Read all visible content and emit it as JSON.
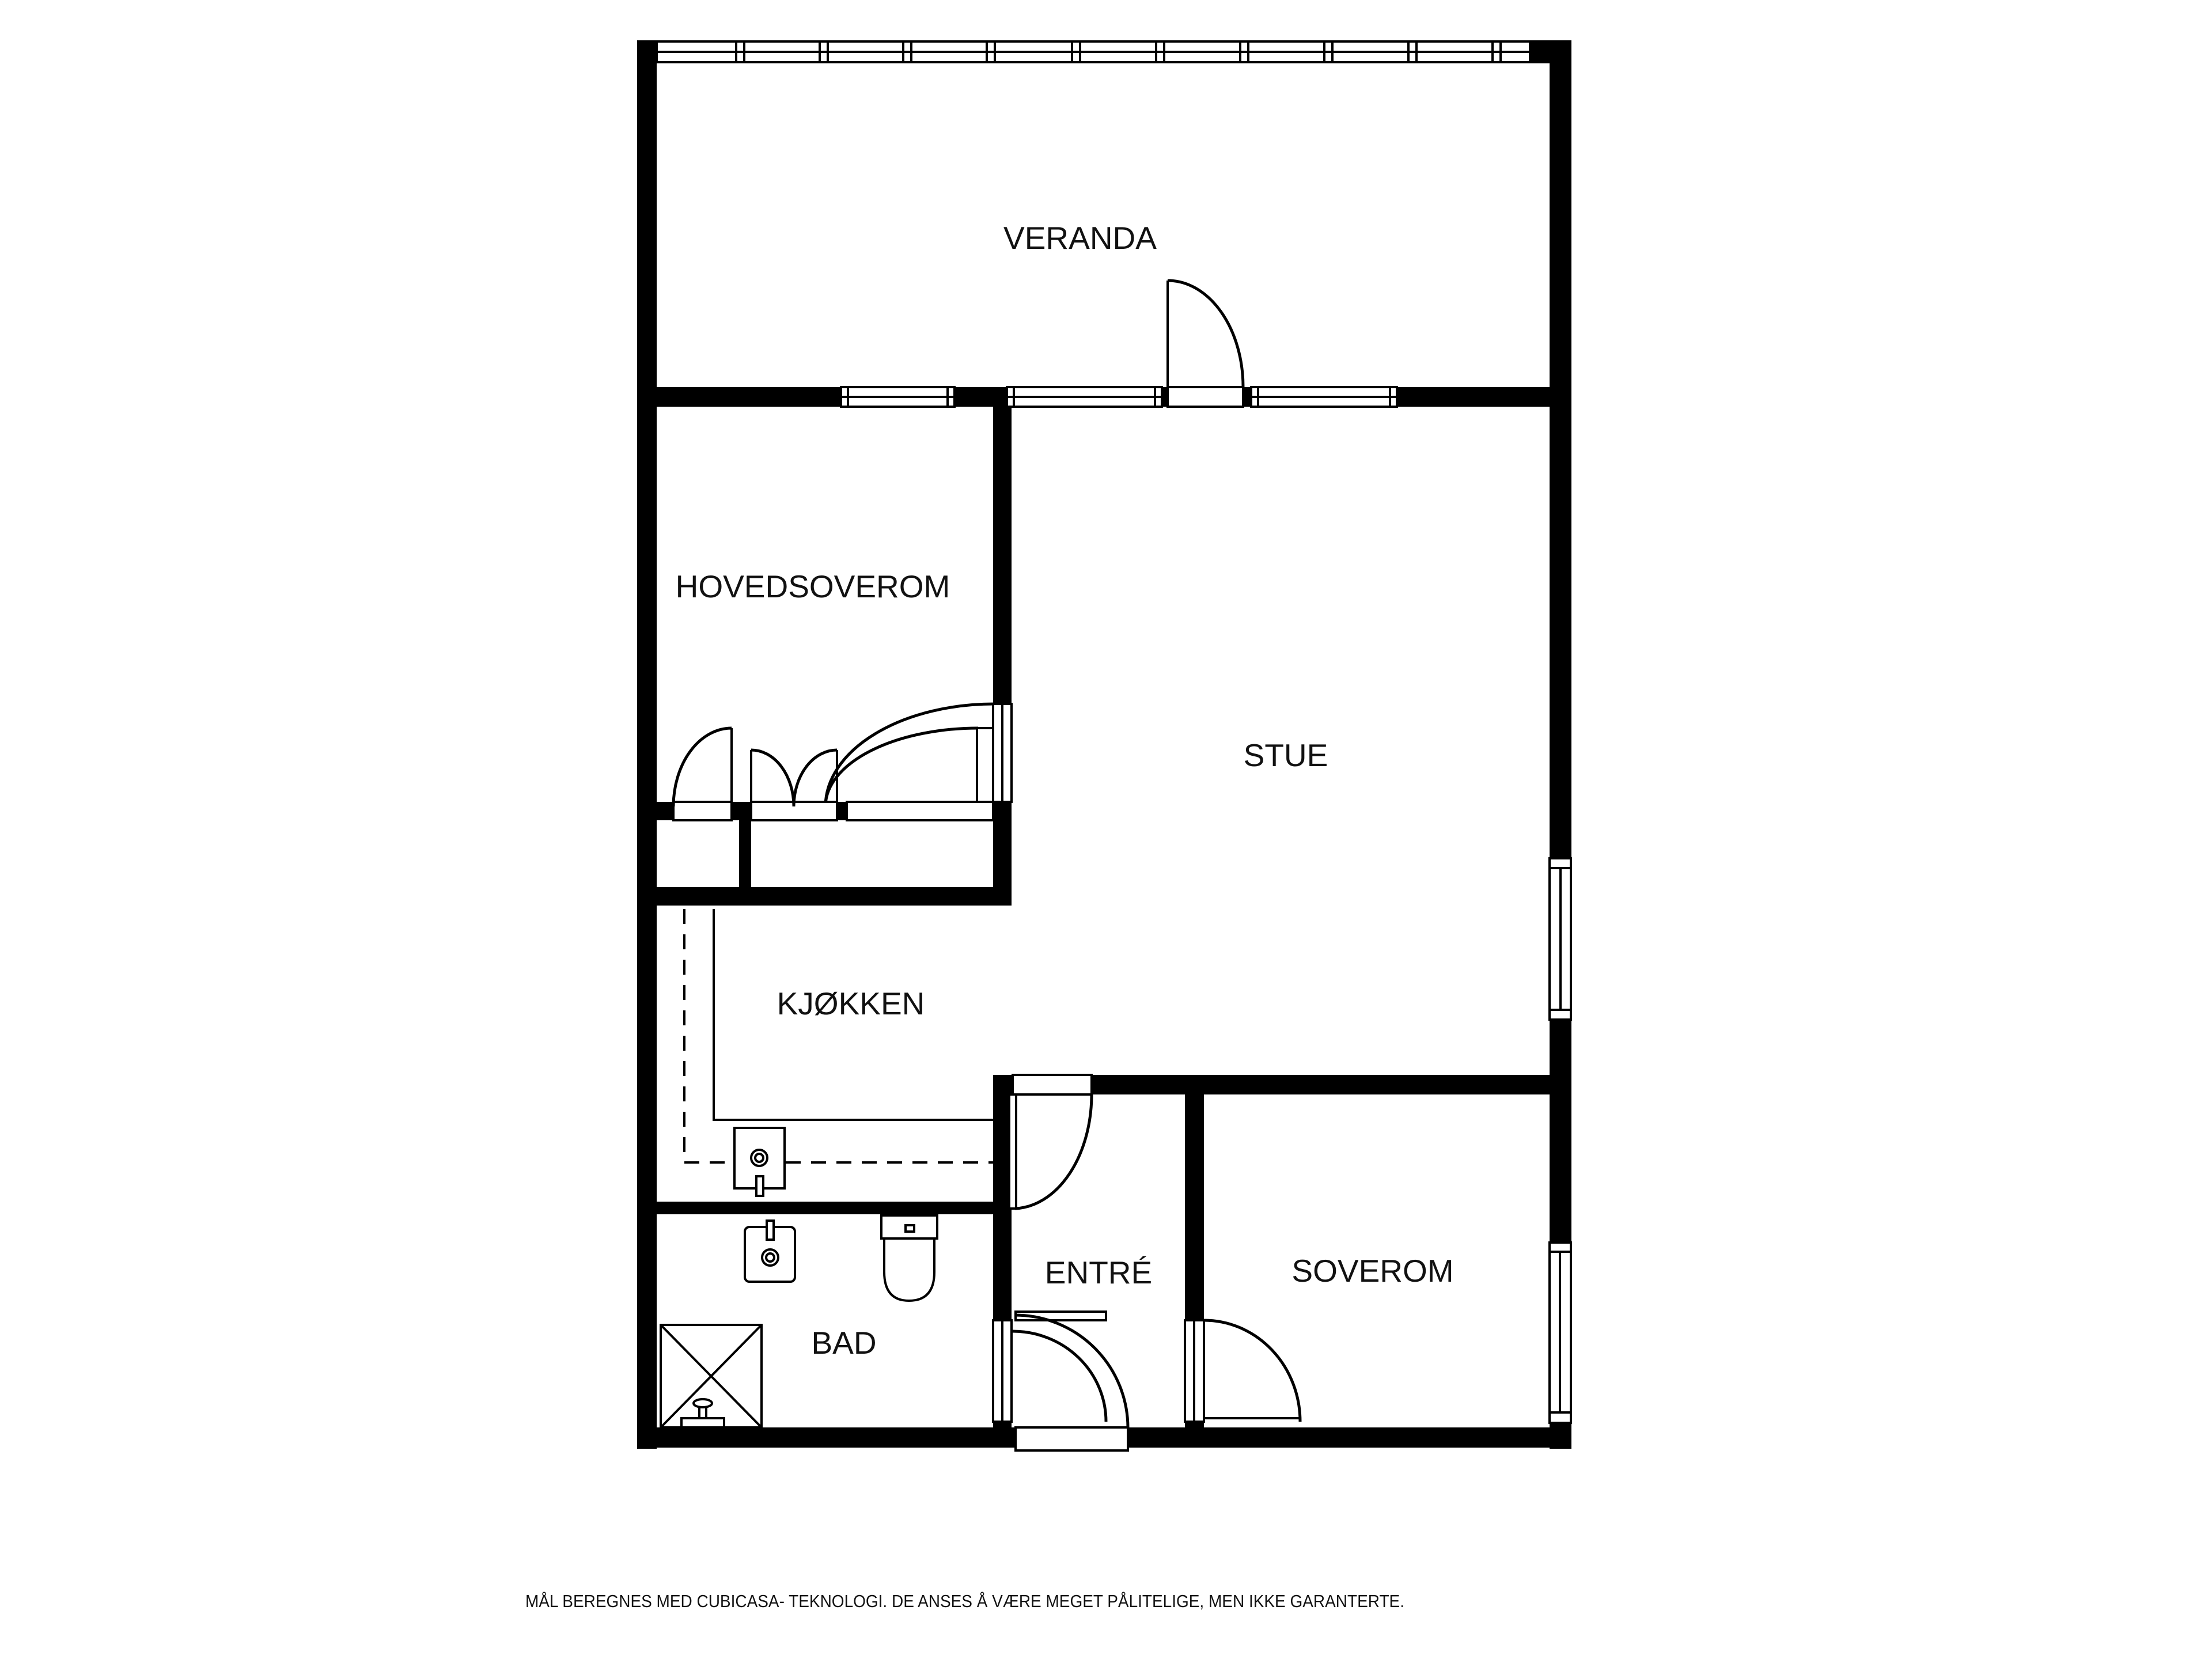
{
  "floorplan": {
    "rooms": [
      {
        "id": "veranda",
        "label": "VERANDA"
      },
      {
        "id": "hovedsoverom",
        "label": "HOVEDSOVEROM"
      },
      {
        "id": "stue",
        "label": "STUE"
      },
      {
        "id": "kjokken",
        "label": "KJØKKEN"
      },
      {
        "id": "entre",
        "label": "ENTRÉ"
      },
      {
        "id": "soverom",
        "label": "SOVEROM"
      },
      {
        "id": "bad",
        "label": "BAD"
      }
    ],
    "disclaimer": "MÅL BEREGNES MED CUBICASA- TEKNOLOGI. DE ANSES Å VÆRE MEGET PÅLITELIGE, MEN IKKE GARANTERTE.",
    "colors": {
      "wall": "#000000",
      "background": "#ffffff",
      "text": "#111111"
    },
    "fixtures": [
      "shower",
      "toilet",
      "bathroom-sink",
      "kitchen-sink",
      "kitchen-counter",
      "wall-cabinets-dashed"
    ]
  }
}
